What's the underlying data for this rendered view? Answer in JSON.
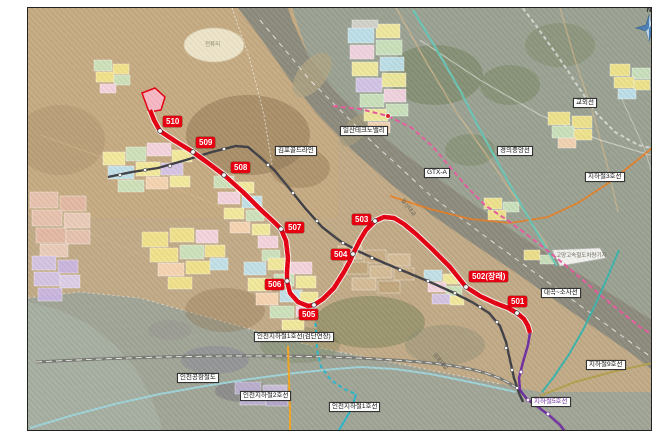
{
  "compass": {
    "label": "N"
  },
  "colors": {
    "route_red": "#e60012",
    "subway5_purple": "#7030a0",
    "gimpo_gold_gray": "#3f3f46",
    "incheon1_cyan": "#29b7cb",
    "incheon2_orange": "#f5a623",
    "subway9_gold": "#b3a14e",
    "gtxa_pink": "#e85ba0",
    "gyeongui_teal": "#6cc5b4",
    "daegok_sosa_teal": "#3cb4ac",
    "beige_land": "#c3ab87",
    "urban_gray": "#9ca393"
  },
  "stations": [
    {
      "label": "510",
      "bx": 163,
      "by": 116,
      "dx": 160,
      "dy": 131
    },
    {
      "label": "509",
      "bx": 196,
      "by": 137,
      "dx": 193,
      "dy": 152
    },
    {
      "label": "508",
      "bx": 231,
      "by": 162,
      "dx": 224,
      "dy": 175
    },
    {
      "label": "507",
      "bx": 285,
      "by": 222,
      "dx": 281,
      "dy": 229
    },
    {
      "label": "506",
      "bx": 265,
      "by": 279,
      "dx": 287,
      "dy": 281
    },
    {
      "label": "505",
      "bx": 299,
      "by": 309,
      "dx": 314,
      "dy": 305
    },
    {
      "label": "504",
      "bx": 331,
      "by": 249,
      "dx": 353,
      "dy": 254
    },
    {
      "label": "503",
      "bx": 352,
      "by": 214,
      "dx": 375,
      "dy": 221
    },
    {
      "label": "502(장래)",
      "bx": 469,
      "by": 271,
      "dx": 466,
      "dy": 287
    },
    {
      "label": "501",
      "bx": 508,
      "by": 296,
      "dx": 517,
      "dy": 313
    }
  ],
  "line_labels": [
    {
      "id": "gimpo-gold-line",
      "text": "김포골드라인",
      "x": 275,
      "y": 146
    },
    {
      "id": "ilsan-technovalley",
      "text": "일산테크노밸리",
      "x": 340,
      "y": 126
    },
    {
      "id": "gyooe-line",
      "text": "교외선",
      "x": 573,
      "y": 98
    },
    {
      "id": "gyeongui-jungang-line",
      "text": "경의중앙선",
      "x": 497,
      "y": 146
    },
    {
      "id": "gtx-a",
      "text": "GTX-A",
      "x": 424,
      "y": 168
    },
    {
      "id": "subway-line3",
      "text": "지하철3호선",
      "x": 585,
      "y": 172
    },
    {
      "id": "daegok-sosa-line",
      "text": "대곡~소사선",
      "x": 541,
      "y": 288
    },
    {
      "id": "subway-line9",
      "text": "지하철9호선",
      "x": 586,
      "y": 360
    },
    {
      "id": "subway-line5",
      "text": "지하철5호선",
      "x": 531,
      "y": 397,
      "color": "#7030a0"
    },
    {
      "id": "incheon-subway-line1",
      "text": "인천지하철1호선",
      "x": 329,
      "y": 402
    },
    {
      "id": "incheon-subway-line2",
      "text": "인천지하철2호선",
      "x": 240,
      "y": 391
    },
    {
      "id": "incheon-airport-railroad",
      "text": "인천공항철도",
      "x": 177,
      "y": 373
    },
    {
      "id": "incheon-line1-geomdan-ext",
      "text": "인천지하철1호선(검단연장)",
      "x": 254,
      "y": 332
    }
  ],
  "area_labels": [
    {
      "id": "jeonnyuri",
      "text": "전류리",
      "x": 205,
      "y": 42,
      "style": "ellipse-text"
    },
    {
      "id": "goyang-depot",
      "text": "고양고속철도차량기지",
      "x": 556,
      "y": 253,
      "style": ""
    },
    {
      "id": "ilsan-bridge",
      "text": "일산대교",
      "x": 404,
      "y": 198,
      "style": "rot"
    },
    {
      "id": "gimpo-bridge",
      "text": "김포대교",
      "x": 436,
      "y": 352,
      "style": "rot"
    }
  ]
}
